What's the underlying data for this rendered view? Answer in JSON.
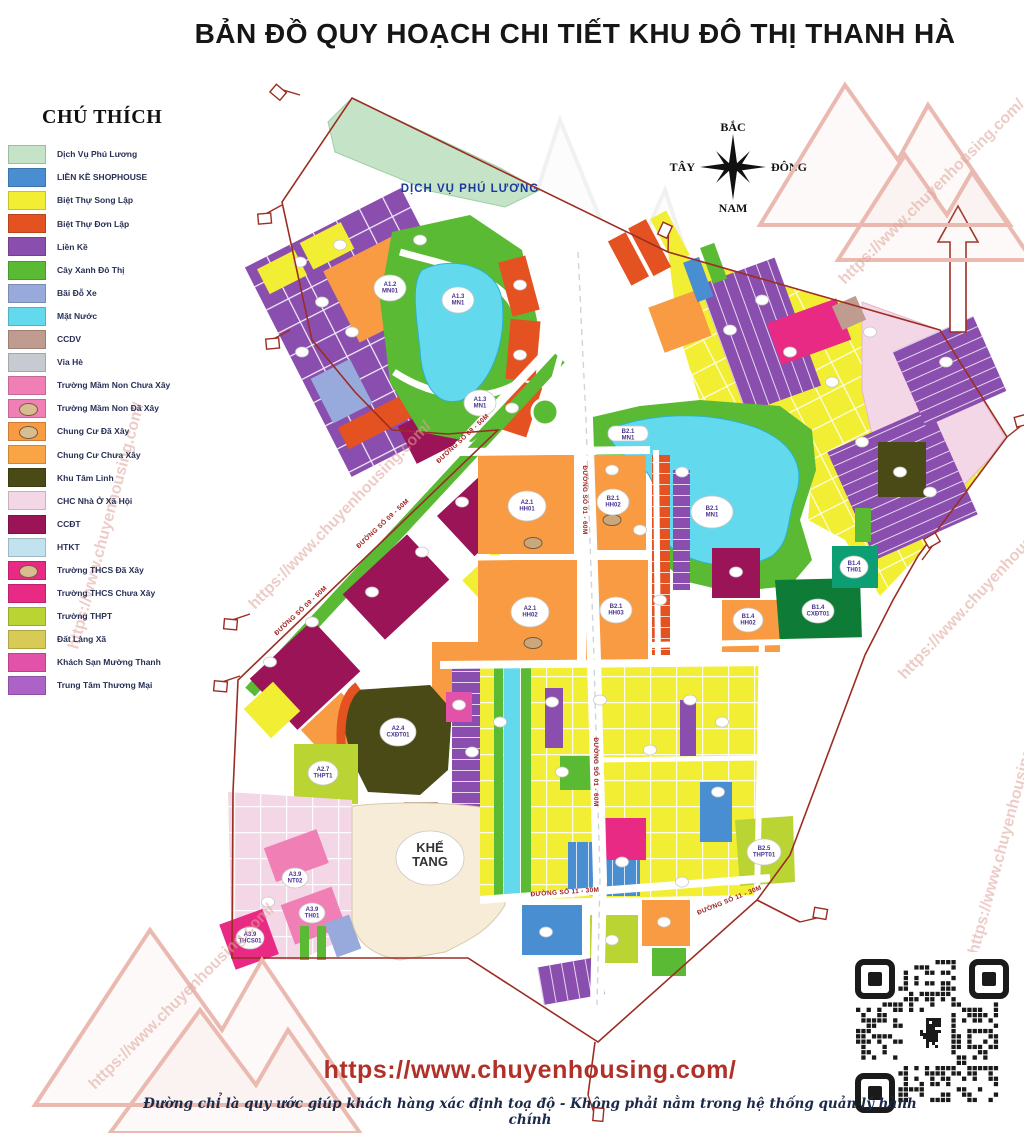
{
  "title": "BẢN ĐỒ QUY HOẠCH CHI TIẾT  KHU ĐÔ THỊ THANH HÀ",
  "legend": {
    "heading": "CHÚ THÍCH",
    "items": [
      {
        "label": "Dịch Vụ Phú Lương",
        "color": "#c5e3c6",
        "badge": false
      },
      {
        "label": "LIỀN KỀ SHOPHOUSE",
        "color": "#4a8ed2",
        "badge": false
      },
      {
        "label": "Biệt Thự Song Lập",
        "color": "#f1ee33",
        "badge": false
      },
      {
        "label": "Biệt Thự Đơn Lập",
        "color": "#e55222",
        "badge": false
      },
      {
        "label": "Liền Kề",
        "color": "#8a4fae",
        "badge": false
      },
      {
        "label": "Cây Xanh Đô Thị",
        "color": "#5aba33",
        "badge": false
      },
      {
        "label": "Bãi Đỗ Xe",
        "color": "#98a9dc",
        "badge": false
      },
      {
        "label": "Mặt Nước",
        "color": "#63d9ee",
        "badge": false
      },
      {
        "label": "CCDV",
        "color": "#c09b90",
        "badge": false
      },
      {
        "label": "Vỉa Hè",
        "color": "#c7cbd1",
        "badge": false
      },
      {
        "label": "Trường Mầm Non Chưa Xây",
        "color": "#f07fb5",
        "badge": false
      },
      {
        "label": "Trường Mầm Non Đã Xây",
        "color": "#f07fb5",
        "badge": true
      },
      {
        "label": "Chung Cư Đã Xây",
        "color": "#f89b42",
        "badge": true
      },
      {
        "label": "Chung Cư Chưa Xây",
        "color": "#f9a445",
        "badge": false
      },
      {
        "label": "Khu Tâm Linh",
        "color": "#4a4a16",
        "badge": false
      },
      {
        "label": "CHC Nhà Ở Xã Hội",
        "color": "#f4d7e6",
        "badge": false
      },
      {
        "label": "CCĐT",
        "color": "#9c1458",
        "badge": false
      },
      {
        "label": "HTKT",
        "color": "#c2e2ef",
        "badge": false
      },
      {
        "label": "Trường THCS Đã Xây",
        "color": "#e92a84",
        "badge": true
      },
      {
        "label": "Trường THCS Chưa Xây",
        "color": "#e92a84",
        "badge": false
      },
      {
        "label": "Trường THPT",
        "color": "#b9d433",
        "badge": false
      },
      {
        "label": "Đất Làng Xã",
        "color": "#d7ca55",
        "badge": false
      },
      {
        "label": "Khách Sạn Mường Thanh",
        "color": "#e352a9",
        "badge": false
      },
      {
        "label": "Trung Tâm Thương Mại",
        "color": "#ac62c6",
        "badge": false
      }
    ]
  },
  "compass": {
    "north": "BẮC",
    "south": "NAM",
    "east": "ĐÔNG",
    "west": "TÂY"
  },
  "map": {
    "labels": {
      "dichvu": "DỊCH VỤ PHÚ LƯƠNG",
      "a13mn1": "A1.3\nMN1",
      "a12mn01": "A1.2\nMN01",
      "a21hh01": "A2.1\nHH01",
      "a21hh02": "A2.1\nHH02",
      "b21hh02": "B2.1\nHH02",
      "b21hh03": "B2.1\nHH03",
      "b21mn1": "B2.1\nMN1",
      "b14hh02": "B1.4\nHH02",
      "b14cxdt01": "B1.4\nCXĐT01",
      "b14th01": "B1.4\nTH01",
      "a24cxdt01": "A2.4\nCXĐT01",
      "a27thpt1": "A2.7\nTHPT1",
      "b25thpt01": "B2.5\nTHPT01",
      "a39nt02": "A3.9\nNT02",
      "a39th01": "A3.9\nTH01",
      "a39thcs01": "A3.9\nTHCS01",
      "khetang": "KHẾ\nTANG"
    },
    "road_labels": {
      "r09": "ĐƯỜNG SỐ 09 - 50M",
      "r01": "ĐƯỜNG SỐ 01 - 60M",
      "r11": "ĐƯỜNG SỐ 11 - 30M"
    }
  },
  "watermark": {
    "text": "https://www.chuyenhousing.com/"
  },
  "footer": {
    "url": "https://www.chuyenhousing.com/",
    "note": "Đường chỉ là quy ước giúp khách hàng xác định toạ độ - Không phải nằm trong hệ thống quản lý hành chính"
  },
  "colors": {
    "dv": "#c5e3c6",
    "sh": "#4a8ed2",
    "sl": "#f1ee33",
    "dl": "#e55222",
    "lk": "#8a4fae",
    "cx": "#5aba33",
    "bx": "#98a9dc",
    "wa": "#63d9ee",
    "cv": "#c09b90",
    "vh": "#c7cbd1",
    "mc": "#f07fb5",
    "cc": "#f89b42",
    "tl": "#4a4a16",
    "xh": "#f4d7e6",
    "ct": "#9c1458",
    "ht": "#c2e2ef",
    "ts": "#e92a84",
    "tp": "#b9d433",
    "dx": "#d7ca55",
    "mt": "#e352a9",
    "tt": "#ac62c6",
    "cxd": "#0e7c36",
    "tht": "#0d9e73",
    "kt": "#f6ecd8",
    "bd": "#9b2d22",
    "rl": "#a02020",
    "url": "#b13128"
  }
}
